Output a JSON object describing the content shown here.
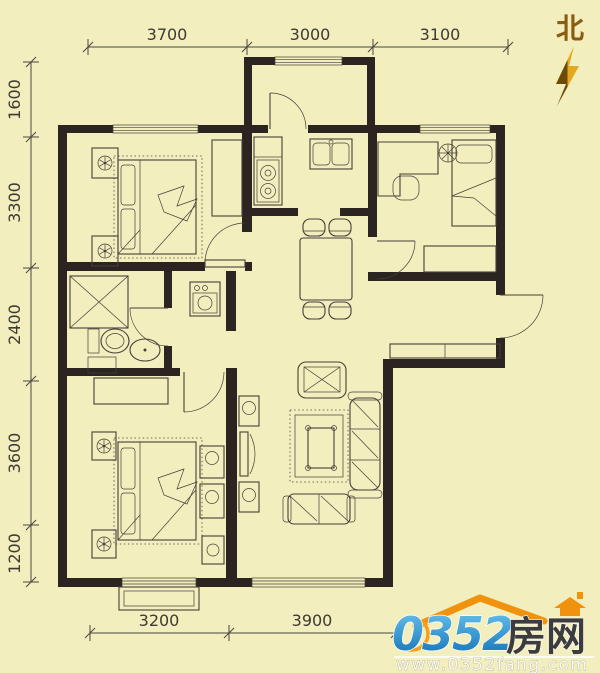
{
  "compass": {
    "label": "北"
  },
  "dimensions": {
    "top": [
      {
        "label": "3700"
      },
      {
        "label": "3000"
      },
      {
        "label": "3100"
      }
    ],
    "left": [
      {
        "label": "1600"
      },
      {
        "label": "3300"
      },
      {
        "label": "2400"
      },
      {
        "label": "3600"
      },
      {
        "label": "1200"
      }
    ],
    "bottom": [
      {
        "label": "3200"
      },
      {
        "label": "3900"
      }
    ]
  },
  "watermark": {
    "number": "0352",
    "cn_name": "房网",
    "url": "www.0352fang.com",
    "colors": {
      "blue": "#1d8fd6",
      "orange": "#f0920e",
      "text_dark": "#3c3c3c"
    }
  },
  "colors": {
    "background": "#f2eebd",
    "walls": "#2b2421",
    "plan_lines": "#45403a",
    "dimension_text": "#3d3a33",
    "compass_brown": "#8a5c12"
  }
}
